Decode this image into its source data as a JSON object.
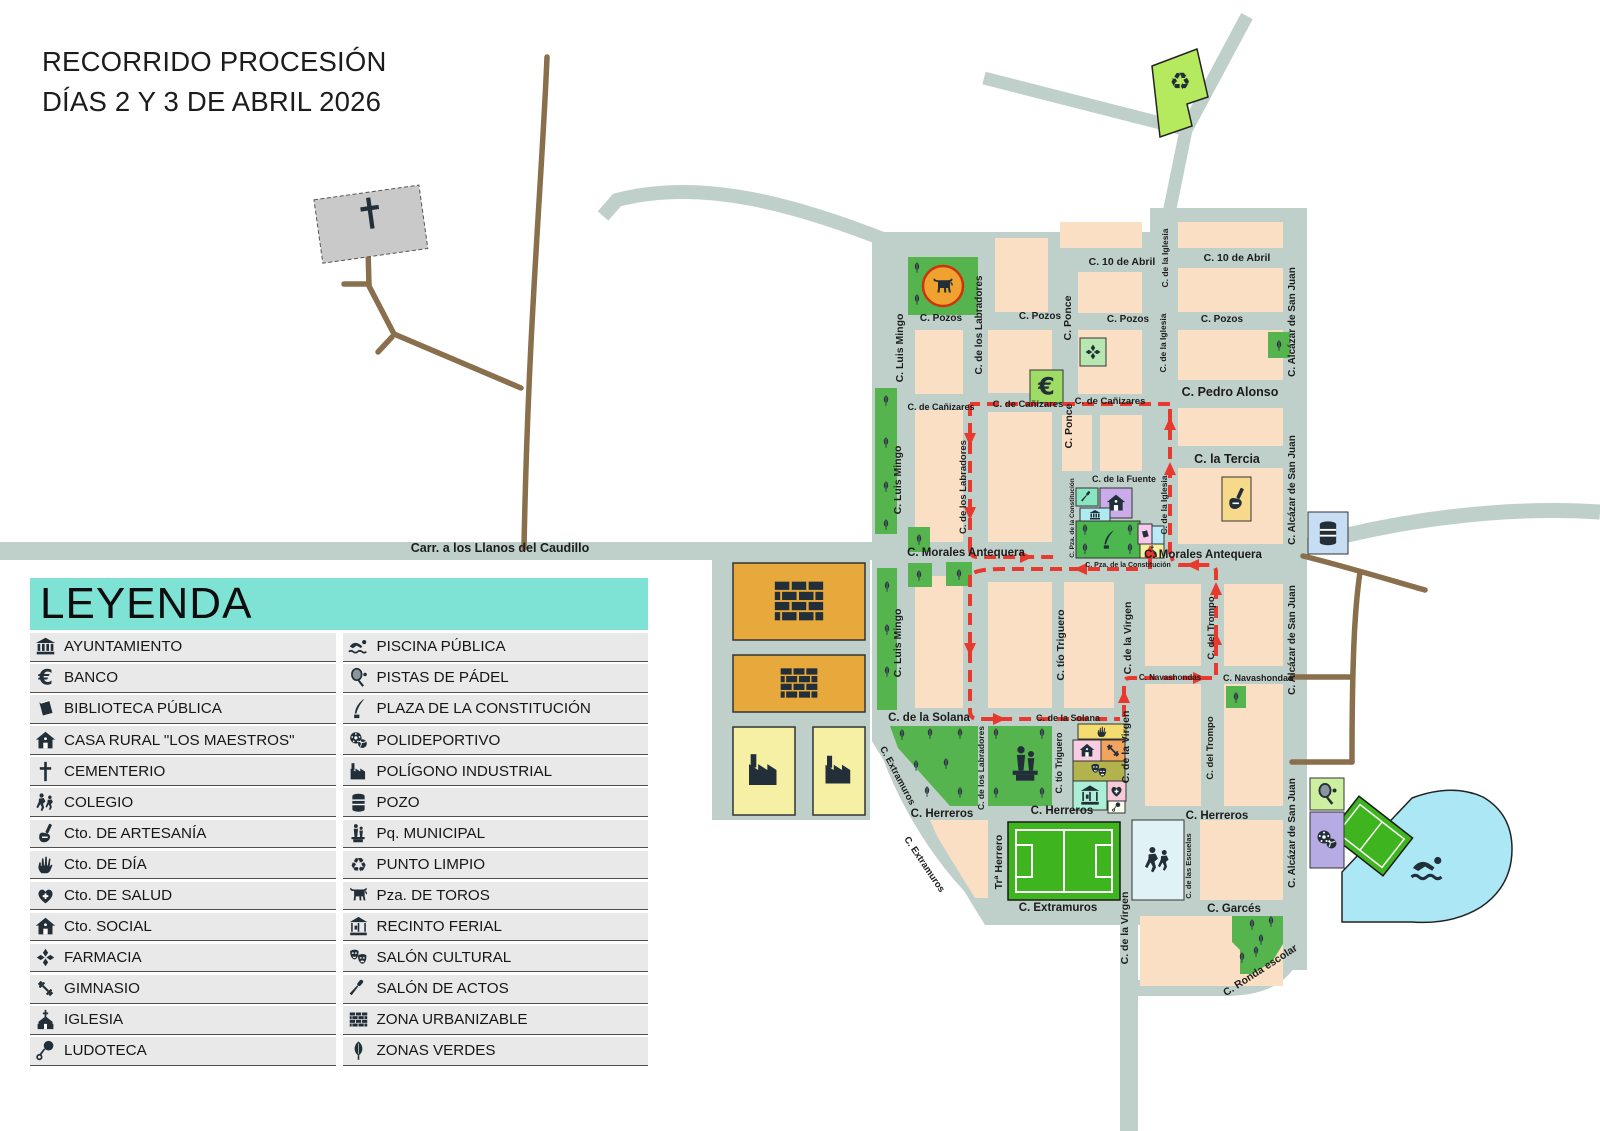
{
  "title": {
    "line1": "RECORRIDO PROCESIÓN",
    "line2": "DÍAS 2 Y 3 DE ABRIL 2026"
  },
  "legend": {
    "header": "LEYENDA",
    "left": [
      {
        "icon": "bank",
        "name": "ayuntamiento",
        "label": "AYUNTAMIENTO"
      },
      {
        "icon": "euro",
        "name": "banco",
        "label": "BANCO"
      },
      {
        "icon": "book",
        "name": "biblioteca-publica",
        "label": "BIBLIOTECA PÚBLICA"
      },
      {
        "icon": "house",
        "name": "casa-rural-los-maestros",
        "label": "CASA RURAL \"LOS MAESTROS\""
      },
      {
        "icon": "cross",
        "name": "cementerio",
        "label": "CEMENTERIO"
      },
      {
        "icon": "kids",
        "name": "colegio",
        "label": "COLEGIO"
      },
      {
        "icon": "craft",
        "name": "cto-de-artesania",
        "label": "Cto. DE ARTESANÍA"
      },
      {
        "icon": "hand",
        "name": "cto-de-dia",
        "label": "Cto. DE DÍA"
      },
      {
        "icon": "heart",
        "name": "cto-de-salud",
        "label": "Cto. DE SALUD"
      },
      {
        "icon": "house",
        "name": "cto-social",
        "label": "Cto. SOCIAL"
      },
      {
        "icon": "maltese",
        "name": "farmacia",
        "label": "FARMACIA"
      },
      {
        "icon": "gym",
        "name": "gimnasio",
        "label": "GIMNASIO"
      },
      {
        "icon": "church",
        "name": "iglesia",
        "label": "IGLESIA"
      },
      {
        "icon": "rattle",
        "name": "ludoteca",
        "label": "LUDOTECA"
      }
    ],
    "right": [
      {
        "icon": "swimmer",
        "name": "piscina-publica",
        "label": "PISCINA PÚBLICA"
      },
      {
        "icon": "racket",
        "name": "pistas-de-padel",
        "label": "PISTAS DE PÁDEL"
      },
      {
        "icon": "quill",
        "name": "plaza-de-la-constitucion",
        "label": "PLAZA DE LA CONSTITUCIÓN"
      },
      {
        "icon": "balls",
        "name": "polideportivo",
        "label": "POLIDEPORTIVO"
      },
      {
        "icon": "factory",
        "name": "poligono-industrial",
        "label": "POLÍGONO INDUSTRIAL"
      },
      {
        "icon": "well",
        "name": "pozo",
        "label": "POZO"
      },
      {
        "icon": "statue",
        "name": "pq-municipal",
        "label": "Pq. MUNICIPAL"
      },
      {
        "icon": "recycle",
        "name": "punto-limpio",
        "label": "PUNTO LIMPIO"
      },
      {
        "icon": "bull",
        "name": "pza-de-toros",
        "label": "Pza. DE TOROS"
      },
      {
        "icon": "carousel",
        "name": "recinto-ferial",
        "label": "RECINTO FERIAL"
      },
      {
        "icon": "masks",
        "name": "salon-cultural",
        "label": "SALÓN CULTURAL"
      },
      {
        "icon": "mic",
        "name": "salon-de-actos",
        "label": "SALÓN DE ACTOS"
      },
      {
        "icon": "bricks",
        "name": "zona-urbanizable",
        "label": "ZONA URBANIZABLE"
      },
      {
        "icon": "tree",
        "name": "zonas-verdes",
        "label": "ZONAS VERDES"
      }
    ]
  },
  "map": {
    "street_labels": [
      {
        "t": "C. 10 de Abril",
        "x": 1122,
        "y": 265,
        "s": 10.5
      },
      {
        "t": "C. 10 de Abril",
        "x": 1237,
        "y": 261,
        "s": 10.5
      },
      {
        "t": "C. Pozos",
        "x": 941,
        "y": 321,
        "s": 10
      },
      {
        "t": "C. Pozos",
        "x": 1040,
        "y": 319,
        "s": 10
      },
      {
        "t": "C. Pozos",
        "x": 1128,
        "y": 322,
        "s": 10
      },
      {
        "t": "C. Pozos",
        "x": 1222,
        "y": 322,
        "s": 10
      },
      {
        "t": "C. de Cañizares",
        "x": 941,
        "y": 410,
        "s": 9
      },
      {
        "t": "C. de Cañizares",
        "x": 1028,
        "y": 407,
        "s": 9.5
      },
      {
        "t": "C. de Cañizares",
        "x": 1110,
        "y": 404,
        "s": 9.5
      },
      {
        "t": "C. Pedro Alonso",
        "x": 1230,
        "y": 396,
        "s": 12.5
      },
      {
        "t": "C. la Tercia",
        "x": 1227,
        "y": 463,
        "s": 12.5
      },
      {
        "t": "C. de la Fuente",
        "x": 1124,
        "y": 482,
        "s": 9
      },
      {
        "t": "C. Morales Antequera",
        "x": 966,
        "y": 556,
        "s": 11.5
      },
      {
        "t": "C. Morales Antequera",
        "x": 1203,
        "y": 558,
        "s": 11.5
      },
      {
        "t": "C. Pza. de la Constitución",
        "x": 1128,
        "y": 567,
        "s": 7
      },
      {
        "t": "C. Navashondas",
        "x": 1258,
        "y": 681,
        "s": 9
      },
      {
        "t": "C. Navashondas",
        "x": 1170,
        "y": 680,
        "s": 8,
        "c": "#e8392e"
      },
      {
        "t": "C. de la Solana",
        "x": 929,
        "y": 721,
        "s": 11.5
      },
      {
        "t": "C. de la Solana",
        "x": 1068,
        "y": 721,
        "s": 9,
        "c": "#e8392e"
      },
      {
        "t": "C. Herreros",
        "x": 942,
        "y": 817,
        "s": 11.5
      },
      {
        "t": "C. Herreros",
        "x": 1062,
        "y": 814,
        "s": 11.5
      },
      {
        "t": "C. Herreros",
        "x": 1217,
        "y": 819,
        "s": 11.5
      },
      {
        "t": "C. Extramuros",
        "x": 1058,
        "y": 911,
        "s": 11.5
      },
      {
        "t": "C. Garcés",
        "x": 1234,
        "y": 912,
        "s": 11.5
      },
      {
        "t": "Carr. a los Llanos del Caudillo",
        "x": 500,
        "y": 552,
        "s": 12.5
      },
      {
        "t": "C. Luis Mingo",
        "x": 903,
        "y": 348,
        "r": -90,
        "s": 10.5
      },
      {
        "t": "C. Luis Mingo",
        "x": 901,
        "y": 480,
        "r": -90,
        "s": 10.5
      },
      {
        "t": "C. Luis Mingo",
        "x": 901,
        "y": 643,
        "r": -90,
        "s": 10.5
      },
      {
        "t": "C. de los Labradores",
        "x": 982,
        "y": 325,
        "r": -90,
        "s": 10
      },
      {
        "t": "C. de los Labradores",
        "x": 966,
        "y": 487,
        "r": -90,
        "s": 9.5
      },
      {
        "t": "C. de los Labradores",
        "x": 984,
        "y": 768,
        "r": -90,
        "s": 8.5
      },
      {
        "t": "C. Ponce",
        "x": 1071,
        "y": 318,
        "r": -90,
        "s": 10.5
      },
      {
        "t": "C. Ponce",
        "x": 1072,
        "y": 426,
        "r": -90,
        "s": 10.5
      },
      {
        "t": "C. tío Triguero",
        "x": 1064,
        "y": 645,
        "r": -90,
        "s": 10.5
      },
      {
        "t": "C. tío Triguero",
        "x": 1062,
        "y": 763,
        "r": -90,
        "s": 9
      },
      {
        "t": "C. de la Iglesia",
        "x": 1168,
        "y": 258,
        "r": -90,
        "s": 8.5
      },
      {
        "t": "C. de la Iglesia",
        "x": 1166,
        "y": 343,
        "r": -90,
        "s": 8.5
      },
      {
        "t": "C. de la Iglesia",
        "x": 1167,
        "y": 505,
        "r": -90,
        "s": 8.5
      },
      {
        "t": "C. Pza. de la Constitución",
        "x": 1074,
        "y": 518,
        "r": -90,
        "s": 6.5
      },
      {
        "t": "C. Alcázar de San Juan",
        "x": 1295,
        "y": 322,
        "r": -90,
        "s": 10
      },
      {
        "t": "C. Alcázar de San Juan",
        "x": 1295,
        "y": 490,
        "r": -90,
        "s": 10
      },
      {
        "t": "C. Alcázar de San Juan",
        "x": 1295,
        "y": 640,
        "r": -90,
        "s": 10
      },
      {
        "t": "C. Alcázar de San Juan",
        "x": 1295,
        "y": 833,
        "r": -90,
        "s": 10
      },
      {
        "t": "C. de la Virgen",
        "x": 1131,
        "y": 638,
        "r": -90,
        "s": 10.5
      },
      {
        "t": "C. de la Virgen",
        "x": 1129,
        "y": 747,
        "r": -90,
        "s": 10.5
      },
      {
        "t": "C. de la Virgen",
        "x": 1128,
        "y": 928,
        "r": -90,
        "s": 10.5
      },
      {
        "t": "C. del Trompo",
        "x": 1214,
        "y": 628,
        "r": -90,
        "s": 9.5
      },
      {
        "t": "C. del Trompo",
        "x": 1213,
        "y": 748,
        "r": -90,
        "s": 9.5
      },
      {
        "t": "C. de las Escuelas",
        "x": 1191,
        "y": 866,
        "r": -90,
        "s": 7.5
      },
      {
        "t": "Trª Herrero",
        "x": 1002,
        "y": 862,
        "r": -90,
        "s": 10.5
      },
      {
        "t": "C. Extramuros",
        "x": 895,
        "y": 777,
        "r": 62,
        "s": 9.5
      },
      {
        "t": "C. Extramuros",
        "x": 922,
        "y": 866,
        "r": 56,
        "s": 9.5
      },
      {
        "t": "C. Ronda escolar",
        "x": 1262,
        "y": 973,
        "r": -33,
        "s": 10.5
      }
    ],
    "pois": [
      {
        "n": "banco",
        "icon": "euro",
        "x": 1030,
        "y": 370,
        "w": 33,
        "h": 33,
        "bg": "#9fdc65",
        "is": 24
      },
      {
        "n": "farmacia",
        "icon": "maltese",
        "x": 1080,
        "y": 338,
        "w": 26,
        "h": 28,
        "bg": "#b9e7b2",
        "is": 18
      },
      {
        "n": "salon-de-actos",
        "icon": "mic",
        "x": 1076,
        "y": 488,
        "w": 22,
        "h": 18,
        "bg": "#8ae6c1",
        "is": 14
      },
      {
        "n": "casa-rural",
        "icon": "house",
        "x": 1100,
        "y": 488,
        "w": 32,
        "h": 30,
        "bg": "#c9ace9",
        "is": 20
      },
      {
        "n": "ayuntamiento",
        "icon": "bank",
        "x": 1080,
        "y": 508,
        "w": 30,
        "h": 14,
        "bg": "#b0e9ef",
        "is": 12
      },
      {
        "n": "plaza-de-la-constitucion",
        "icon": "quill",
        "x": 1076,
        "y": 521,
        "w": 64,
        "h": 37,
        "bg": "#4cb64f",
        "is": 20
      },
      {
        "n": "biblioteca-publica",
        "icon": "book",
        "x": 1138,
        "y": 524,
        "w": 14,
        "h": 20,
        "bg": "#f6c9ec",
        "is": 11
      },
      {
        "n": "edificio",
        "icon": "",
        "x": 1152,
        "y": 526,
        "w": 12,
        "h": 18,
        "bg": "#b8ebf5"
      },
      {
        "n": "iglesia",
        "icon": "church",
        "x": 1140,
        "y": 544,
        "w": 24,
        "h": 14,
        "bg": "#f5f0a0",
        "is": 13
      },
      {
        "n": "cto-de-artesania",
        "icon": "craft",
        "x": 1222,
        "y": 477,
        "w": 29,
        "h": 44,
        "bg": "#f7d98c",
        "is": 24
      },
      {
        "n": "pozo",
        "icon": "well",
        "x": 1308,
        "y": 512,
        "w": 40,
        "h": 42,
        "bg": "#c6ddf4",
        "is": 28
      },
      {
        "n": "cto-de-dia",
        "icon": "hand",
        "x": 1078,
        "y": 724,
        "w": 48,
        "h": 15,
        "bg": "#f3dd71",
        "is": 13
      },
      {
        "n": "cto-social",
        "icon": "house",
        "x": 1073,
        "y": 740,
        "w": 28,
        "h": 21,
        "bg": "#f8cce3",
        "is": 16
      },
      {
        "n": "gimnasio",
        "icon": "gym",
        "x": 1101,
        "y": 740,
        "w": 24,
        "h": 21,
        "bg": "#f2a35e",
        "is": 17
      },
      {
        "n": "salon-cultural",
        "icon": "masks",
        "x": 1073,
        "y": 761,
        "w": 52,
        "h": 20,
        "bg": "#b2b34c",
        "is": 19
      },
      {
        "n": "recinto-ferial",
        "icon": "carousel",
        "x": 1073,
        "y": 781,
        "w": 34,
        "h": 29,
        "bg": "#abefd6",
        "is": 22
      },
      {
        "n": "cto-de-salud",
        "icon": "heart",
        "x": 1107,
        "y": 781,
        "w": 19,
        "h": 20,
        "bg": "#f8c9d9",
        "is": 15
      },
      {
        "n": "ludoteca",
        "icon": "rattle",
        "x": 1108,
        "y": 801,
        "w": 17,
        "h": 12,
        "bg": "#fdfdf0",
        "is": 10
      },
      {
        "n": "colegio",
        "icon": "kids",
        "x": 1132,
        "y": 820,
        "w": 52,
        "h": 80,
        "bg": "#e0f2f6",
        "is": 30
      },
      {
        "n": "pistas-de-padel",
        "icon": "racket",
        "x": 1310,
        "y": 778,
        "w": 34,
        "h": 32,
        "bg": "#cdf0a0",
        "is": 24
      },
      {
        "n": "polideportivo",
        "icon": "balls",
        "x": 1310,
        "y": 812,
        "w": 34,
        "h": 56,
        "bg": "#b7abe4",
        "is": 24
      }
    ],
    "route_color": "#e8392e"
  },
  "colors": {
    "road": "#bfd0ca",
    "block": "#fbdfc4",
    "green": "#56b44e",
    "legend_header_bg": "#7ee3d4",
    "route": "#e8392e",
    "urbanizable": "#e7a93c",
    "industrial": "#f6f0a5",
    "pool": "#abe7f4",
    "field": "#3eb51e",
    "dirt_road": "#8a6f4d"
  }
}
